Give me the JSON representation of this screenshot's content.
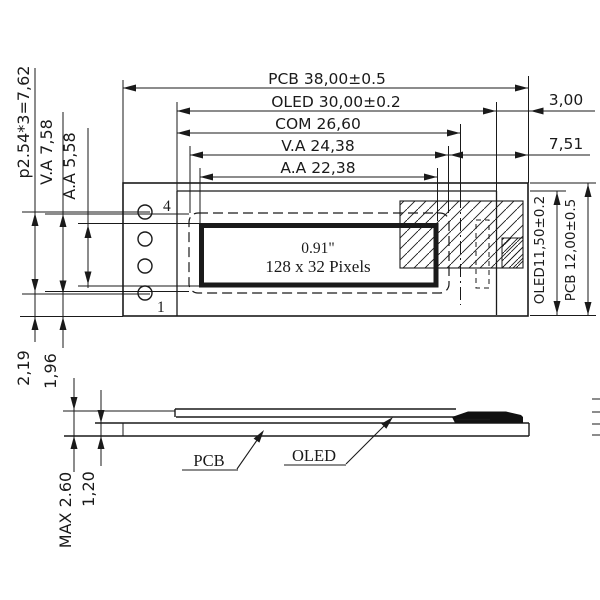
{
  "page": {
    "background": "#ffffff",
    "line_color": "#1a1a1a"
  },
  "top_view": {
    "dims_horizontal": {
      "pcb_width": "PCB 38,00±0.5",
      "oled_width": "OLED 30,00±0.2",
      "com_width": "COM 26,60",
      "va_width": "V.A 24,38",
      "aa_width": "A.A 22,38",
      "right_offset": "3,00",
      "right_gap": "7,51"
    },
    "dims_vertical_left": {
      "pin_pitch": "p2.54*3=7,62",
      "va_height": "V.A 7,58",
      "aa_height": "A.A 5,58"
    },
    "dims_vertical_right": {
      "oled_height": "OLED11,50±0.2",
      "pcb_height": "PCB 12,00±0.5"
    },
    "pins": {
      "top_label": "4",
      "bottom_label": "1",
      "count": 4
    },
    "display": {
      "diagonal": "0.91\"",
      "resolution": "128 x 32 Pixels"
    }
  },
  "side_view": {
    "dims": {
      "pin_row_to_edge": "2,19",
      "edge_offset": "1,96",
      "max_thickness": "MAX 2.60",
      "pcb_thickness": "1,20"
    },
    "labels": {
      "pcb": "PCB",
      "oled": "OLED"
    }
  }
}
